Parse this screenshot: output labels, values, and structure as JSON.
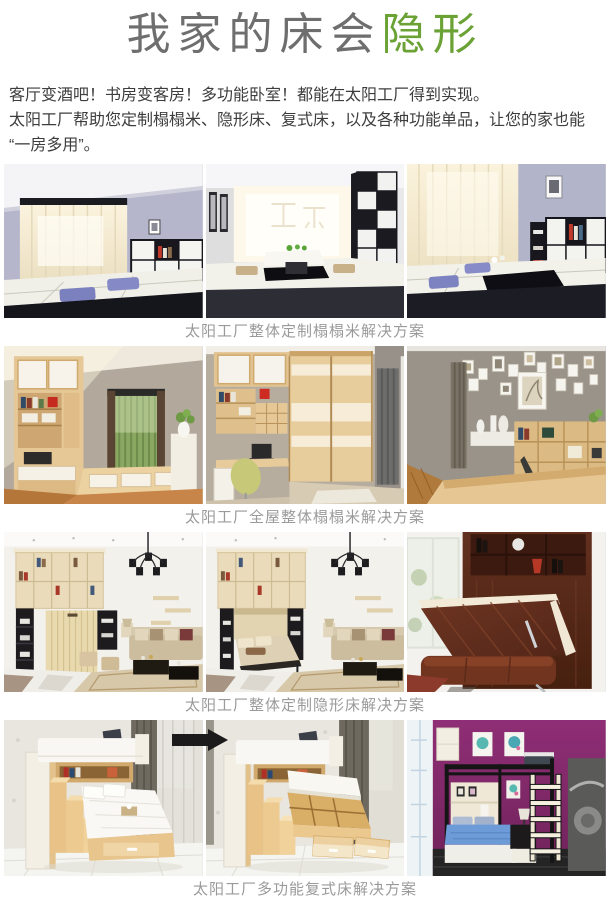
{
  "header": {
    "title_normal": "我家的床会",
    "title_highlight": "隐形",
    "highlight_color": "#6ba235"
  },
  "intro": {
    "line1": "客厅变酒吧！书房变客房！多功能卧室！都能在太阳工厂得到实现。",
    "line2": "太阳工厂帮助您定制榻榻米、隐形床、复式床，以及各种功能单品，让您的家也能",
    "line3": "“一房多用”。"
  },
  "sections": [
    {
      "caption": "太阳工厂整体定制榻榻米解决方案",
      "photos": [
        "black-white-tatami-window-room",
        "black-white-tatami-tea-table-room",
        "black-white-tatami-corner-room"
      ]
    },
    {
      "caption": "太阳工厂全屋整体榻榻米解决方案",
      "photos": [
        "wood-study-bay-window-room",
        "wood-desk-sliding-wardrobe-room",
        "photo-wall-shelving-room"
      ]
    },
    {
      "caption": "太阳工厂整体定制隐形床解决方案",
      "photos": [
        "murphy-bed-closed-living-room",
        "murphy-bed-open-living-room",
        "mahogany-folding-wall-bed"
      ]
    },
    {
      "caption": "太阳工厂多功能复式床解决方案",
      "photos": [
        "storage-stair-bed-closed",
        "storage-stair-bed-open",
        "loft-bed-purple-room"
      ]
    }
  ]
}
